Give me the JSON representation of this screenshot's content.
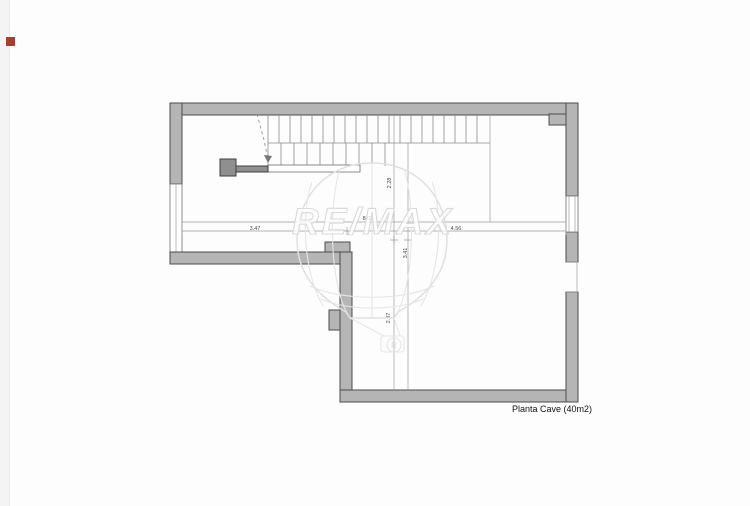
{
  "page": {
    "plan_label": "Planta Cave (40m2)"
  },
  "watermark": {
    "brand": "RE/MAX",
    "registered_mark": "R"
  },
  "marker": {
    "color": "#b03a2e",
    "name": "red-marker-square"
  },
  "colors": {
    "wall_fill": "#b5b5b5",
    "wall_stroke": "#4c4c4c",
    "drawing_line": "#8a8a8a",
    "dimension_text": "#4a4a4a",
    "watermark_stroke": "#e0e0e0",
    "background": "#ffffff"
  },
  "dimensions": {
    "total_width": "8.03",
    "left_width": "3.47",
    "right_width": "4.56",
    "stair_depth": "2.28",
    "mid_height": "3.41",
    "lower_height": "2.87"
  }
}
